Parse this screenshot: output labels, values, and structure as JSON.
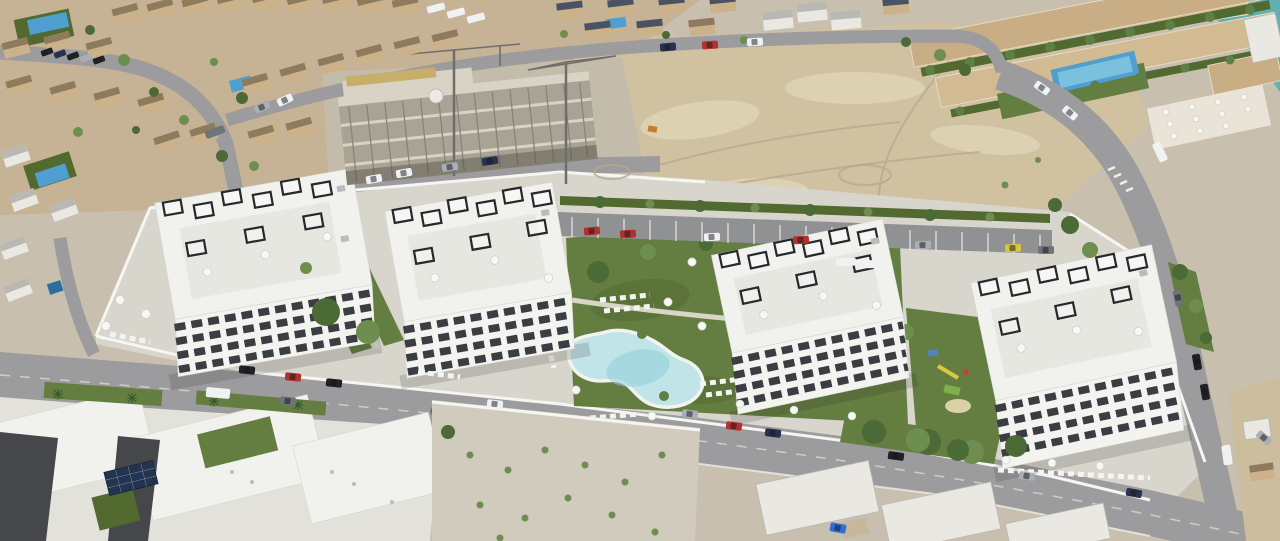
{
  "meta": {
    "description": "Aerial drone view of a new residential development: four white apartment blocks with black rooftop pergolas around a lagoon-shaped communal pool, lawns and playground, bordered by streets with parked cars, existing tan villas, a building under construction with two tower cranes, vacant sandy lots, a terraced resort complex with pool and palm trees, and a glimpse of turquoise sea at the top right."
  },
  "scene": {
    "regions": [
      {
        "name": "residential-northwest",
        "label": "existing tan villas with small pools"
      },
      {
        "name": "construction-site",
        "label": "concrete frame under construction, two tower cranes"
      },
      {
        "name": "vacant-lot",
        "label": "sandy vacant land"
      },
      {
        "name": "resort-complex-northeast",
        "label": "terraced apartments, pool, palm hedges, parasol plaza"
      },
      {
        "name": "sea-glimpse",
        "label": "turquoise water at top right corner"
      },
      {
        "name": "new-development",
        "label": "four new white apartment blocks with pergola roof terraces"
      },
      {
        "name": "communal-pool",
        "label": "lagoon-shaped pool with sun loungers and parasols"
      },
      {
        "name": "playground",
        "label": "children's play area on lawn"
      },
      {
        "name": "residents-parking",
        "label": "marked parking bays with cars"
      },
      {
        "name": "main-street",
        "label": "street with parked cars and palm-lined sidewalk"
      },
      {
        "name": "existing-apartments-southwest",
        "label": "white flat roofs with solar panels"
      },
      {
        "name": "gravel-lot-south",
        "label": "gravel yard with young shrubs"
      },
      {
        "name": "villas-southeast",
        "label": "white villas by the lower road"
      }
    ],
    "counts": {
      "new_apartment_blocks": 4,
      "tower_cranes": 2,
      "communal_pools": 1,
      "small_private_pools": 5,
      "resort_pools": 1
    }
  },
  "palette": {
    "ground_base": "#c8bfae",
    "sea": "#5fb1b5",
    "resi_ground": "#c6b295",
    "house_tan": "#cbb28a",
    "house_roof": "#8e7a5c",
    "roof_slate": "#4a5363",
    "white_house": "#e9e8e2",
    "gray_roof": "#b9b8b2",
    "dirt": "#d0c1a1",
    "dirt_light": "#ddd1b4",
    "dirt_track": "#b9a98b",
    "concrete_pad": "#c3bcab",
    "concrete": "#a9a396",
    "concrete_floor": "#d9d3c5",
    "formwork": "#c7ae6b",
    "crane": "#6e6e6a",
    "road": "#9c9c9e",
    "road_line": "#dadad6",
    "pavement": "#d8d5cd",
    "wall": "#f5f5f1",
    "lawn": "#647d40",
    "lawn_dark": "#52692f",
    "tree": "#4c6a36",
    "tree_light": "#6e8e50",
    "palm": "#5d8045",
    "pool_water": "#c0e4e7",
    "pool_deep": "#8ed0d9",
    "pool_blue": "#4f9fd0",
    "white_bld": "#f1f1ed",
    "facade": "#f3f3ef",
    "penthouse": "#e7e7e2",
    "window_dark": "#3a3d41",
    "pergola": "#26282b",
    "tan_terrace": "#c9ae85",
    "tan_terrace2": "#d2ba93",
    "plaza": "#e9e4d7",
    "solar": "#233450",
    "gravel": "#d1cbbd",
    "dark_facade": "#45474a",
    "shadow": "rgba(35,35,40,0.16)",
    "parasol": "#f7f7f4",
    "car_red": "#b23230",
    "car_darkblue": "#28324e",
    "car_black": "#202124",
    "car_silver": "#a9afb5",
    "car_white": "#eff1f2",
    "car_yellow": "#d9c440",
    "car_gray": "#6f747a",
    "car_blue": "#2f6fd0"
  }
}
